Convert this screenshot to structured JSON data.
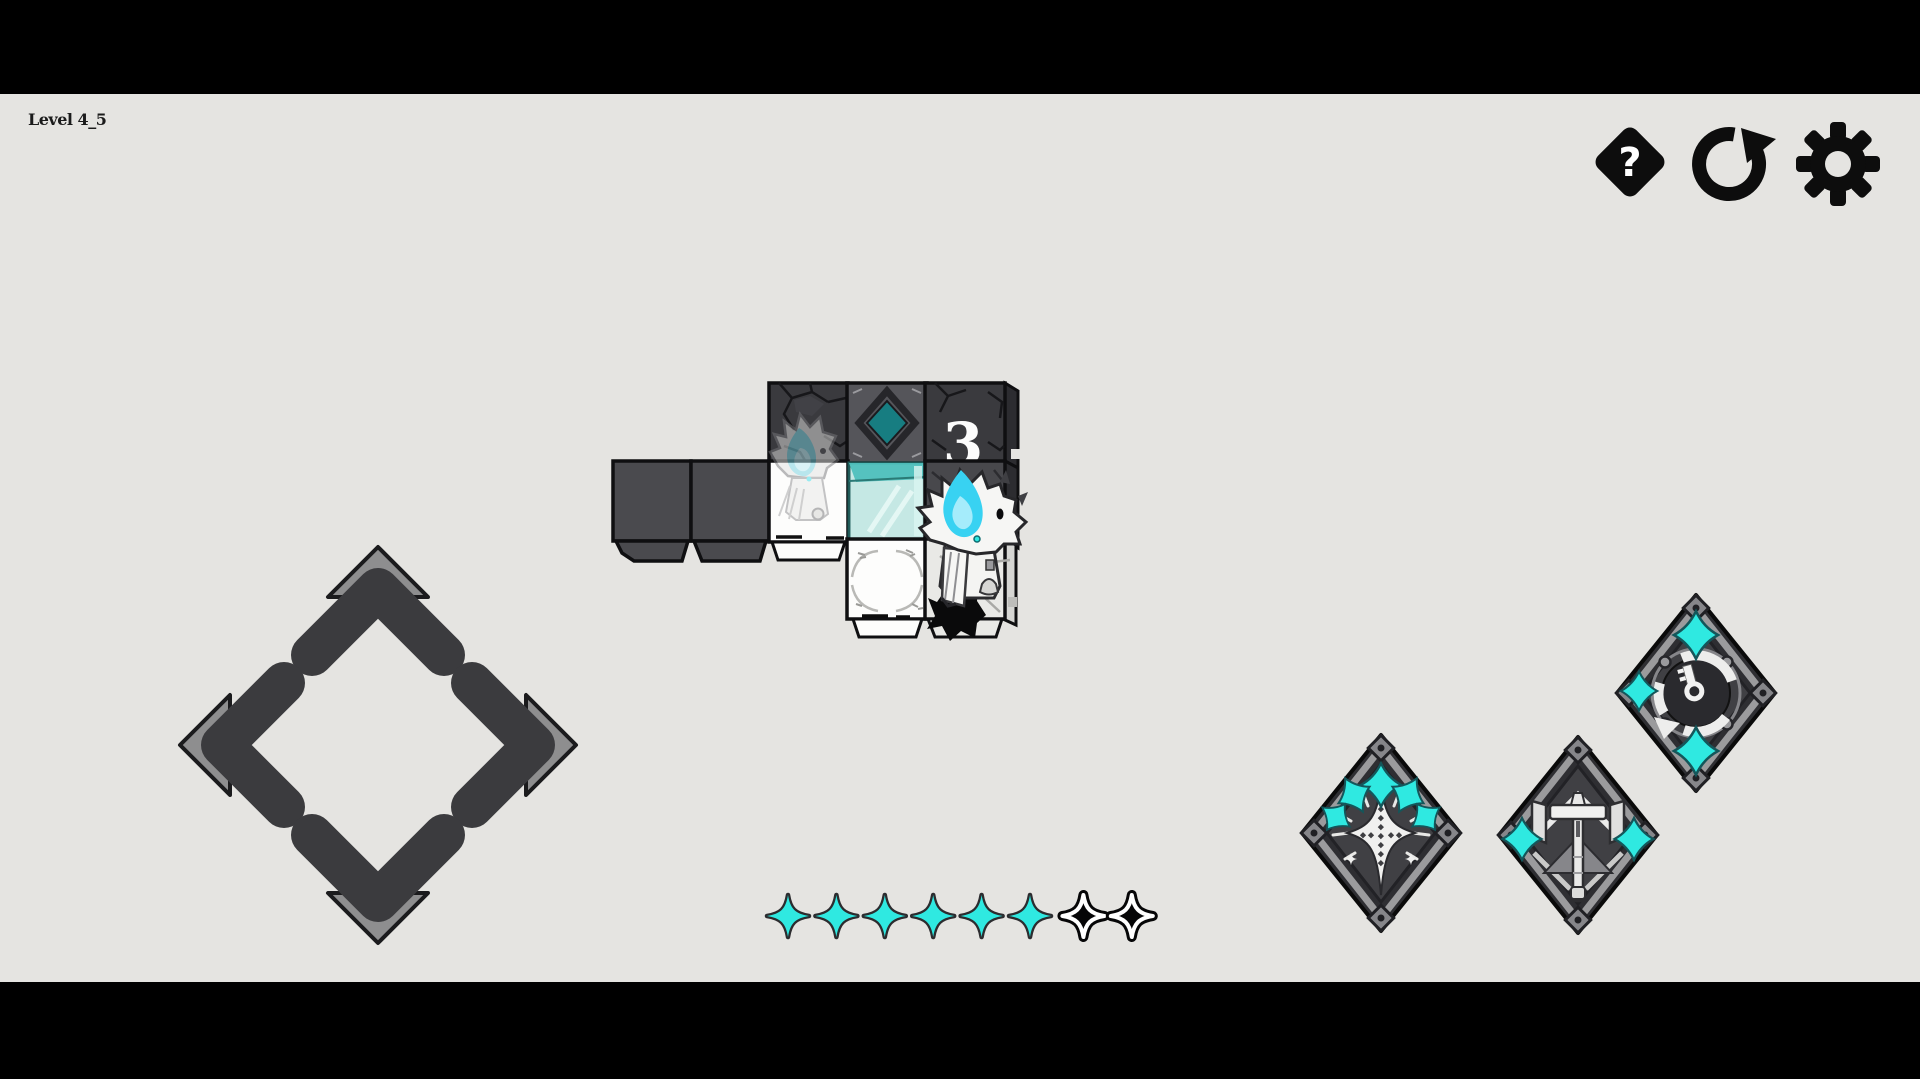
{
  "hud": {
    "level_label": "Level 4_5",
    "help_glyph": "?",
    "buttons": [
      {
        "id": "help",
        "icon": "question-diamond-icon"
      },
      {
        "id": "restart",
        "icon": "restart-arrow-icon"
      },
      {
        "id": "settings",
        "icon": "gear-icon"
      }
    ]
  },
  "board": {
    "counter_value": "3",
    "tiles": [
      {
        "row": 0,
        "col": 2,
        "type": "dark-cracked-cube"
      },
      {
        "row": 0,
        "col": 3,
        "type": "gem-emblem-cube",
        "gem": "teal-diamond"
      },
      {
        "row": 0,
        "col": 4,
        "type": "dark-cracked-cube",
        "counter": "3"
      },
      {
        "row": 1,
        "col": 0,
        "type": "dark-cube"
      },
      {
        "row": 1,
        "col": 1,
        "type": "dark-cube"
      },
      {
        "row": 1,
        "col": 2,
        "type": "white-tile",
        "occupant": "ghost-preview-character"
      },
      {
        "row": 1,
        "col": 3,
        "type": "glass-tile"
      },
      {
        "row": 1,
        "col": 4,
        "type": "dark-tile",
        "occupant": "player-character"
      },
      {
        "row": 2,
        "col": 3,
        "type": "white-ornate-tile"
      },
      {
        "row": 2,
        "col": 4,
        "type": "stone-tile",
        "occupant": "player-tail"
      }
    ]
  },
  "dpad": {
    "directions": [
      "up",
      "left",
      "right",
      "down"
    ]
  },
  "progress": {
    "total": 8,
    "completed": 6,
    "states": [
      "filled",
      "filled",
      "filled",
      "filled",
      "filled",
      "filled",
      "empty",
      "empty"
    ]
  },
  "abilities": [
    {
      "id": "burst",
      "icon": "burst-sparkle-badge-icon"
    },
    {
      "id": "hammer",
      "icon": "hammer-totem-badge-icon"
    },
    {
      "id": "rotate",
      "icon": "rotate-arrows-badge-icon"
    }
  ],
  "colors": {
    "background": "#e5e4e1",
    "letterbox": "#000000",
    "ink": "#0d0d0d",
    "cube_face": "#4a4a4e",
    "cube_dark": "#3a3a3e",
    "cube_side": "#2c2c30",
    "tile_white": "#fdfdfc",
    "tile_stone": "#e9e9e6",
    "emblem_teal": "#177d81",
    "glass_band": "#4fc0bd",
    "glass_body": "#c3e9e5",
    "dpad_dark": "#3b3b3e",
    "dpad_light": "#8e8e8f",
    "accent": "#2fe9e1",
    "flame": "#38d2f2",
    "flame_light": "#a5ecfb",
    "badge_rim": "#2e2e32",
    "badge_frame": "#9b9b9d",
    "badge_inner": "#404044",
    "badge_white": "#f0f0ef",
    "badge_gray": "#86868a"
  }
}
